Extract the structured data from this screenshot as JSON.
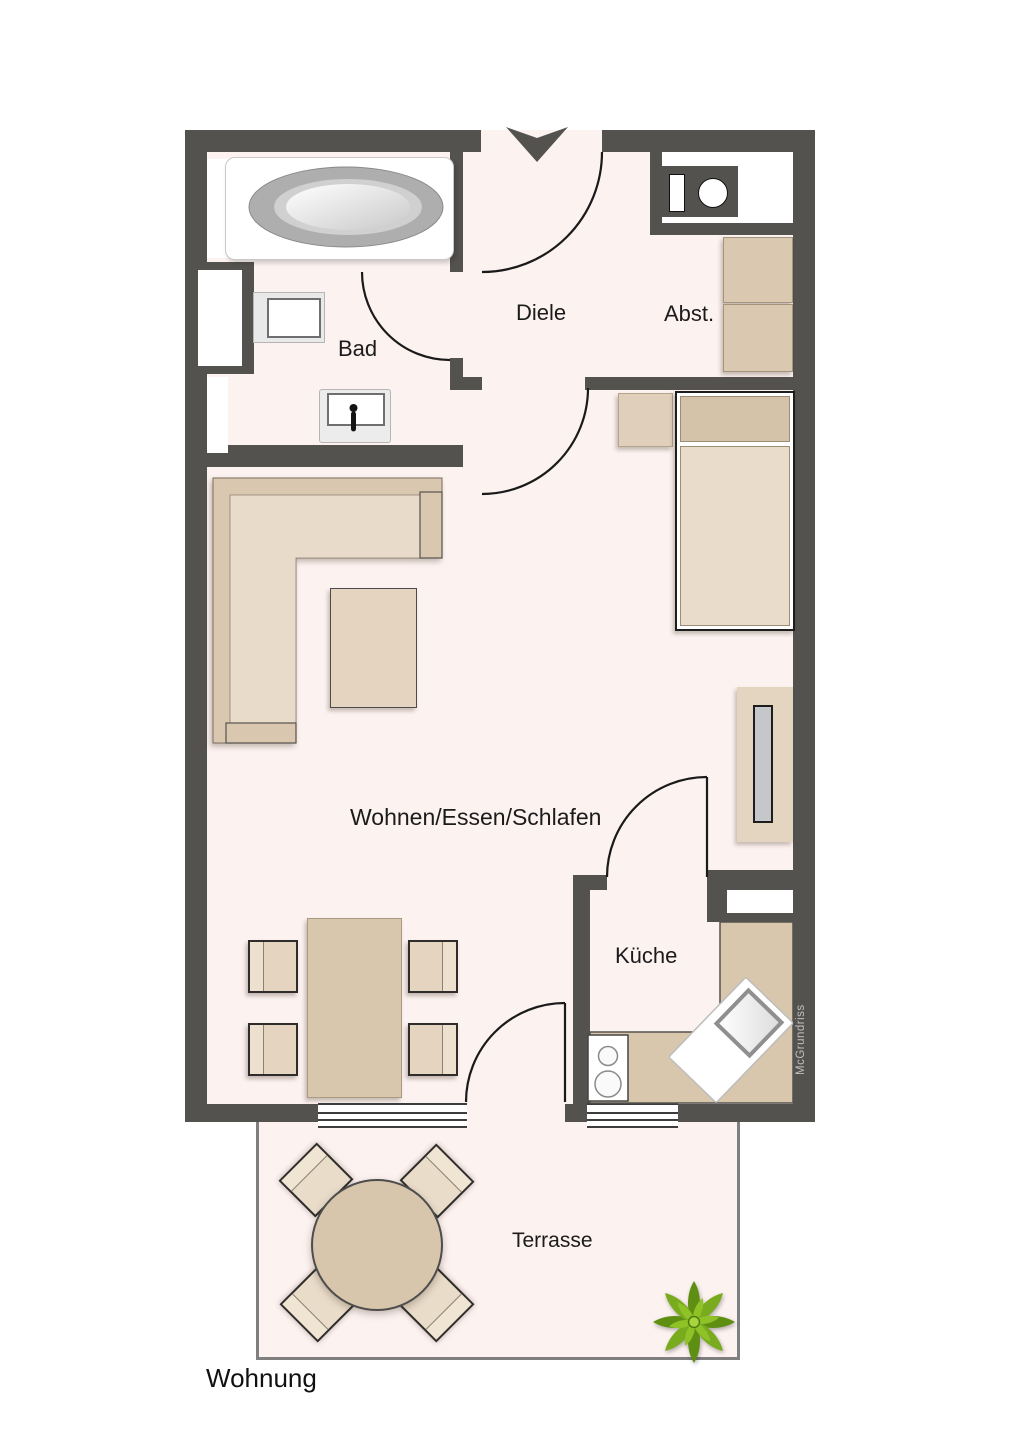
{
  "plan": {
    "title": "Wohnung",
    "watermark": "McGrundriss"
  },
  "rooms": {
    "bad": {
      "label": "Bad"
    },
    "diele": {
      "label": "Diele"
    },
    "abstellraum": {
      "label": "Abst."
    },
    "wohnen_essen_schlafen": {
      "label": "Wohnen/Essen/Schlafen"
    },
    "kueche": {
      "label": "Küche"
    },
    "terrasse": {
      "label": "Terrasse"
    }
  },
  "icons": {
    "entrance_arrow": "triangle-down",
    "plant": "star-succulent"
  },
  "colors": {
    "wall": "#54524f",
    "floor": "#fcf2f0",
    "furniture": "#dbc8b0",
    "furniture_light": "#e9dbc9",
    "counter": "#d9c7ad",
    "door_line": "#1a1a1a",
    "terrace_border": "#7f7f7f",
    "plant_green": "#79ab1e"
  }
}
